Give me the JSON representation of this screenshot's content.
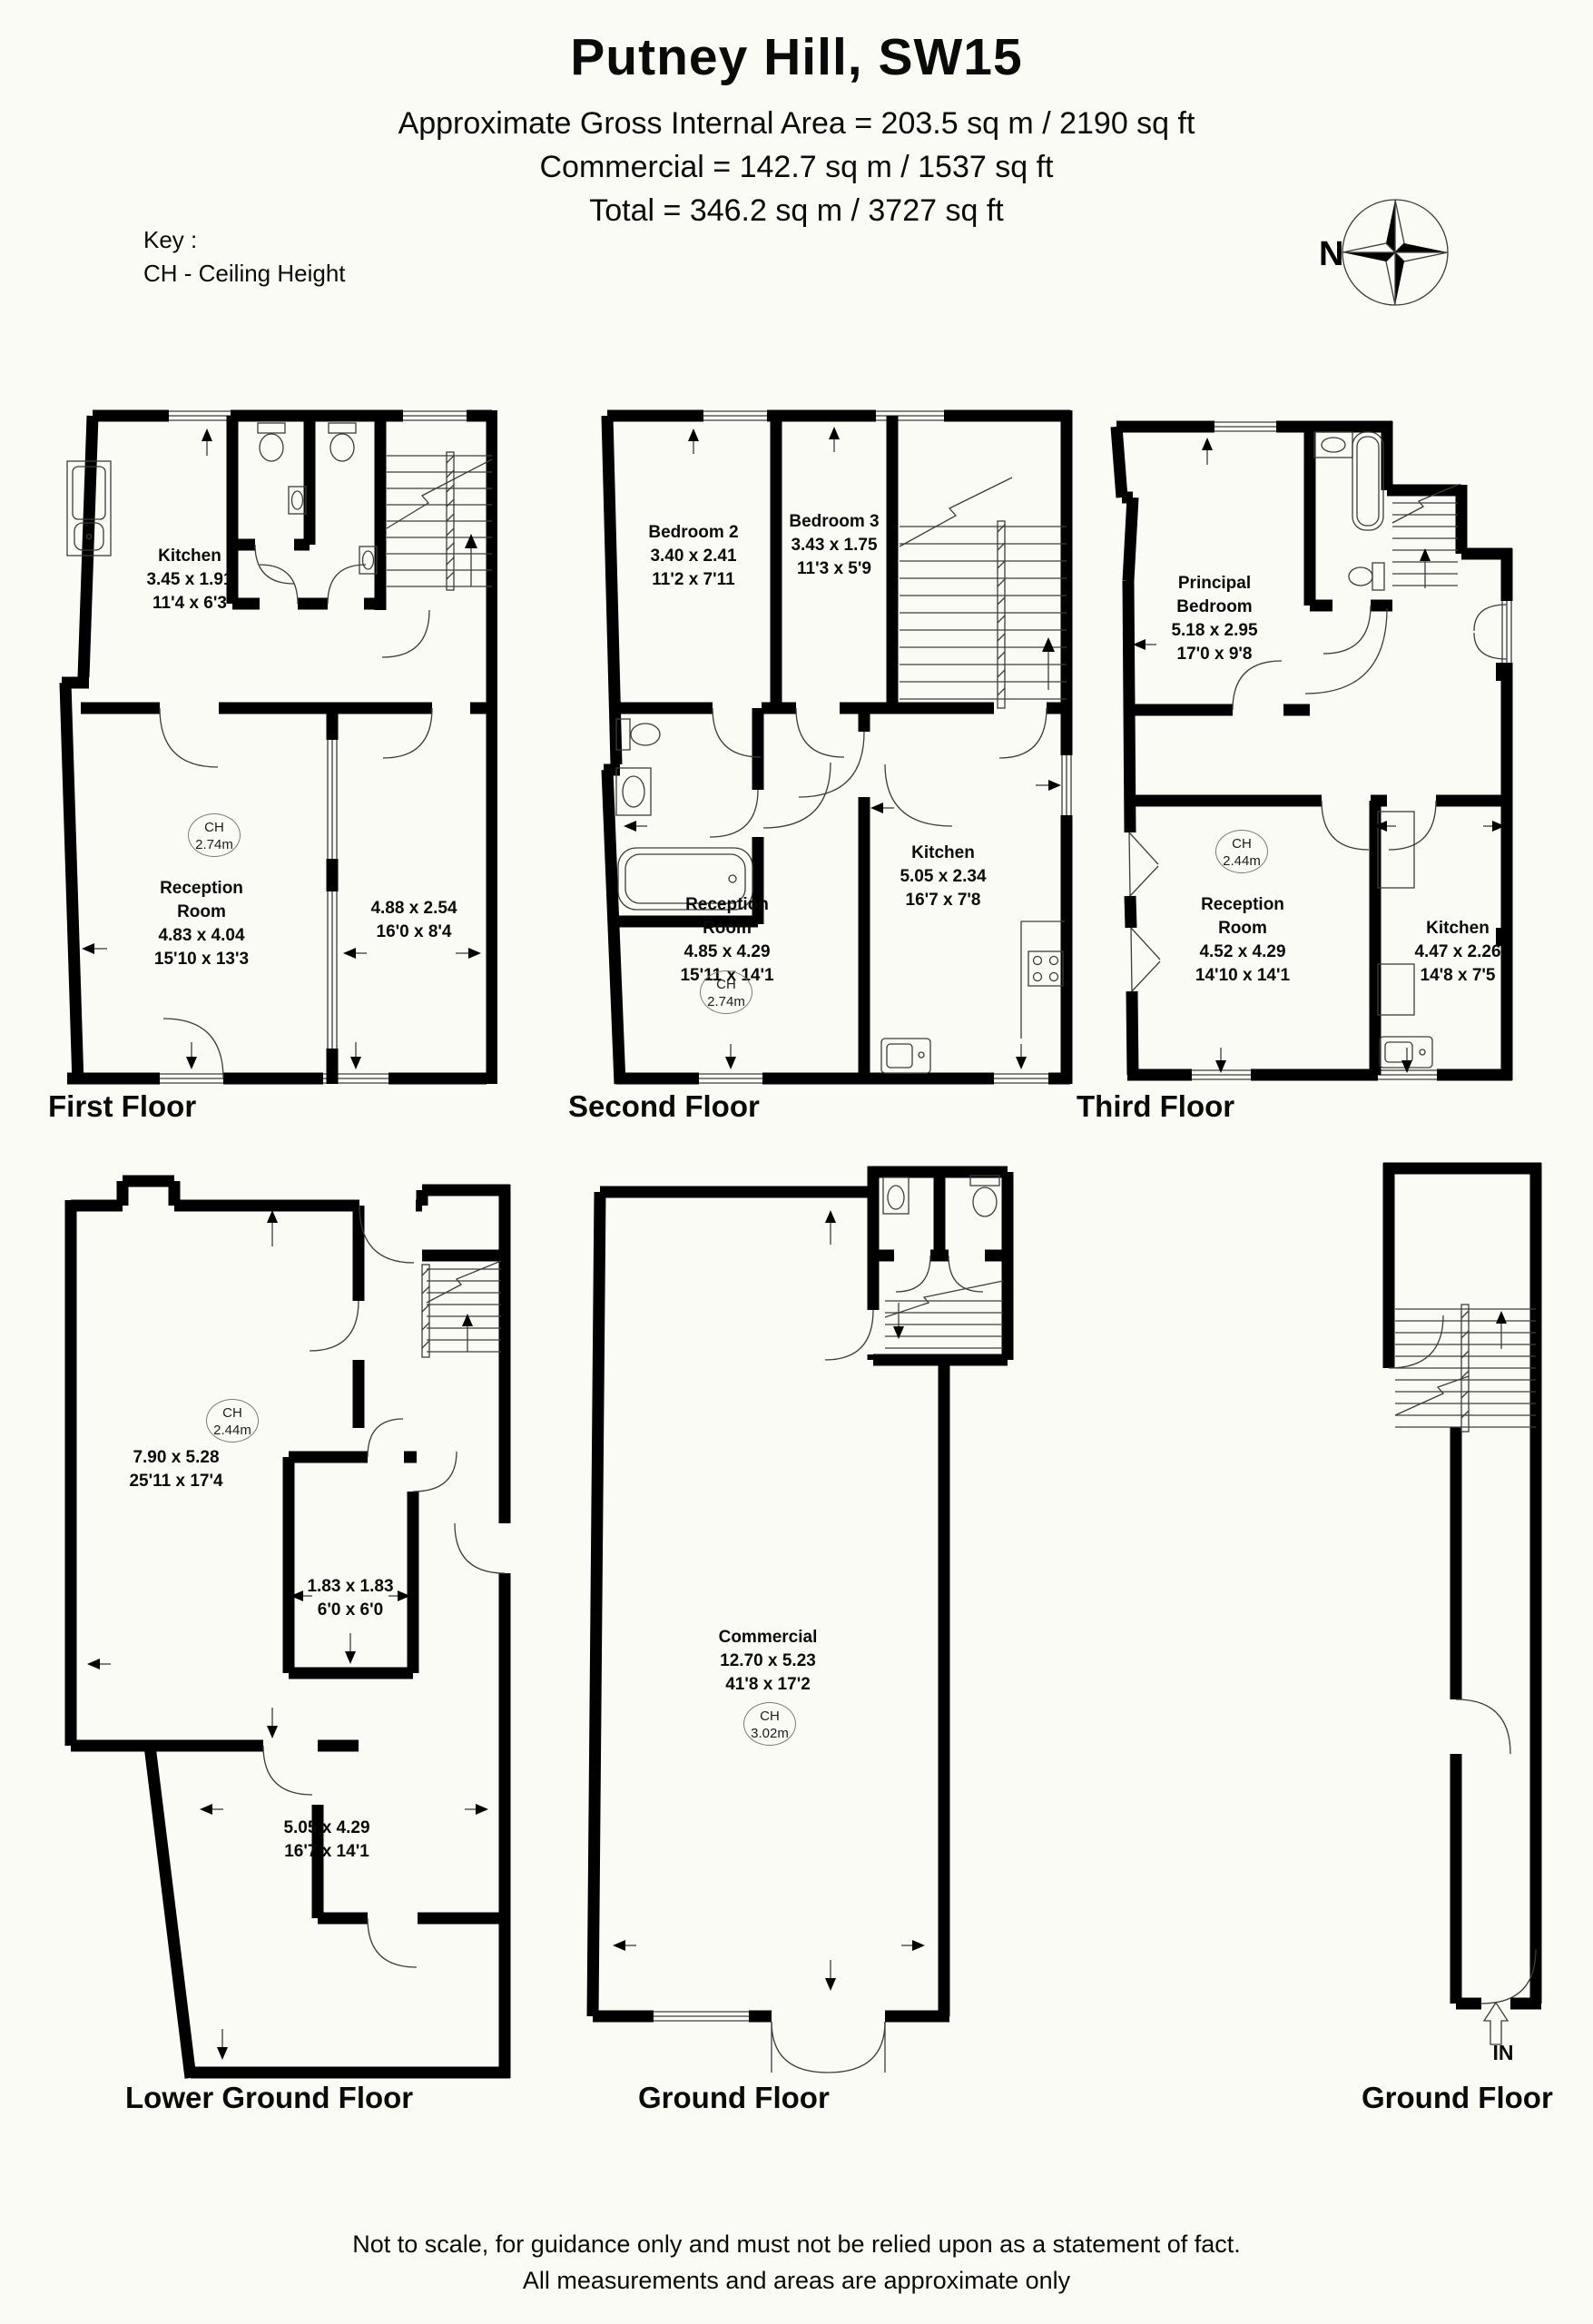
{
  "header": {
    "title": "Putney Hill, SW15",
    "area_line": "Approximate Gross Internal Area = 203.5 sq m / 2190 sq ft",
    "commercial_line": "Commercial = 142.7 sq m / 1537 sq ft",
    "total_line": "Total = 346.2 sq m / 3727 sq ft"
  },
  "key": {
    "heading": "Key :",
    "item": "CH - Ceiling Height"
  },
  "compass": {
    "north": "N"
  },
  "floors": {
    "first": {
      "title": "First Floor",
      "kitchen": {
        "name": "Kitchen",
        "metric": "3.45 x 1.91",
        "imperial": "11'4 x 6'3"
      },
      "reception": {
        "name": "Reception Room",
        "metric": "4.83 x 4.04",
        "imperial": "15'10 x 13'3"
      },
      "rear_room": {
        "metric": "4.88 x 2.54",
        "imperial": "16'0 x 8'4"
      },
      "ch": {
        "label": "CH",
        "value": "2.74m"
      }
    },
    "second": {
      "title": "Second Floor",
      "bedroom2": {
        "name": "Bedroom 2",
        "metric": "3.40 x 2.41",
        "imperial": "11'2 x 7'11"
      },
      "bedroom3": {
        "name": "Bedroom 3",
        "metric": "3.43 x 1.75",
        "imperial": "11'3 x 5'9"
      },
      "kitchen": {
        "name": "Kitchen",
        "metric": "5.05 x 2.34",
        "imperial": "16'7 x 7'8"
      },
      "reception": {
        "name": "Reception Room",
        "metric": "4.85 x 4.29",
        "imperial": "15'11 x 14'1"
      },
      "ch": {
        "label": "CH",
        "value": "2.74m"
      }
    },
    "third": {
      "title": "Third Floor",
      "principal": {
        "name": "Principal Bedroom",
        "metric": "5.18 x 2.95",
        "imperial": "17'0 x 9'8"
      },
      "reception": {
        "name": "Reception Room",
        "metric": "4.52 x 4.29",
        "imperial": "14'10 x 14'1"
      },
      "kitchen": {
        "name": "Kitchen",
        "metric": "4.47 x 2.26",
        "imperial": "14'8 x 7'5"
      },
      "ch": {
        "label": "CH",
        "value": "2.44m"
      }
    },
    "lower_ground": {
      "title": "Lower Ground Floor",
      "front_room": {
        "metric": "7.90 x 5.28",
        "imperial": "25'11 x 17'4"
      },
      "store": {
        "metric": "1.83 x 1.83",
        "imperial": "6'0 x 6'0"
      },
      "rear_room": {
        "metric": "5.05 x 4.29",
        "imperial": "16'7 x 14'1"
      },
      "ch": {
        "label": "CH",
        "value": "2.44m"
      }
    },
    "ground": {
      "title": "Ground Floor",
      "commercial": {
        "name": "Commercial",
        "metric": "12.70 x 5.23",
        "imperial": "41'8 x 17'2"
      },
      "ch": {
        "label": "CH",
        "value": "3.02m"
      }
    },
    "ground_entrance": {
      "title": "Ground Floor",
      "entry": "IN"
    }
  },
  "disclaimer": {
    "line1": "Not to scale, for guidance only and must not be relied upon as a statement of fact.",
    "line2": "All measurements and areas are approximate only"
  }
}
